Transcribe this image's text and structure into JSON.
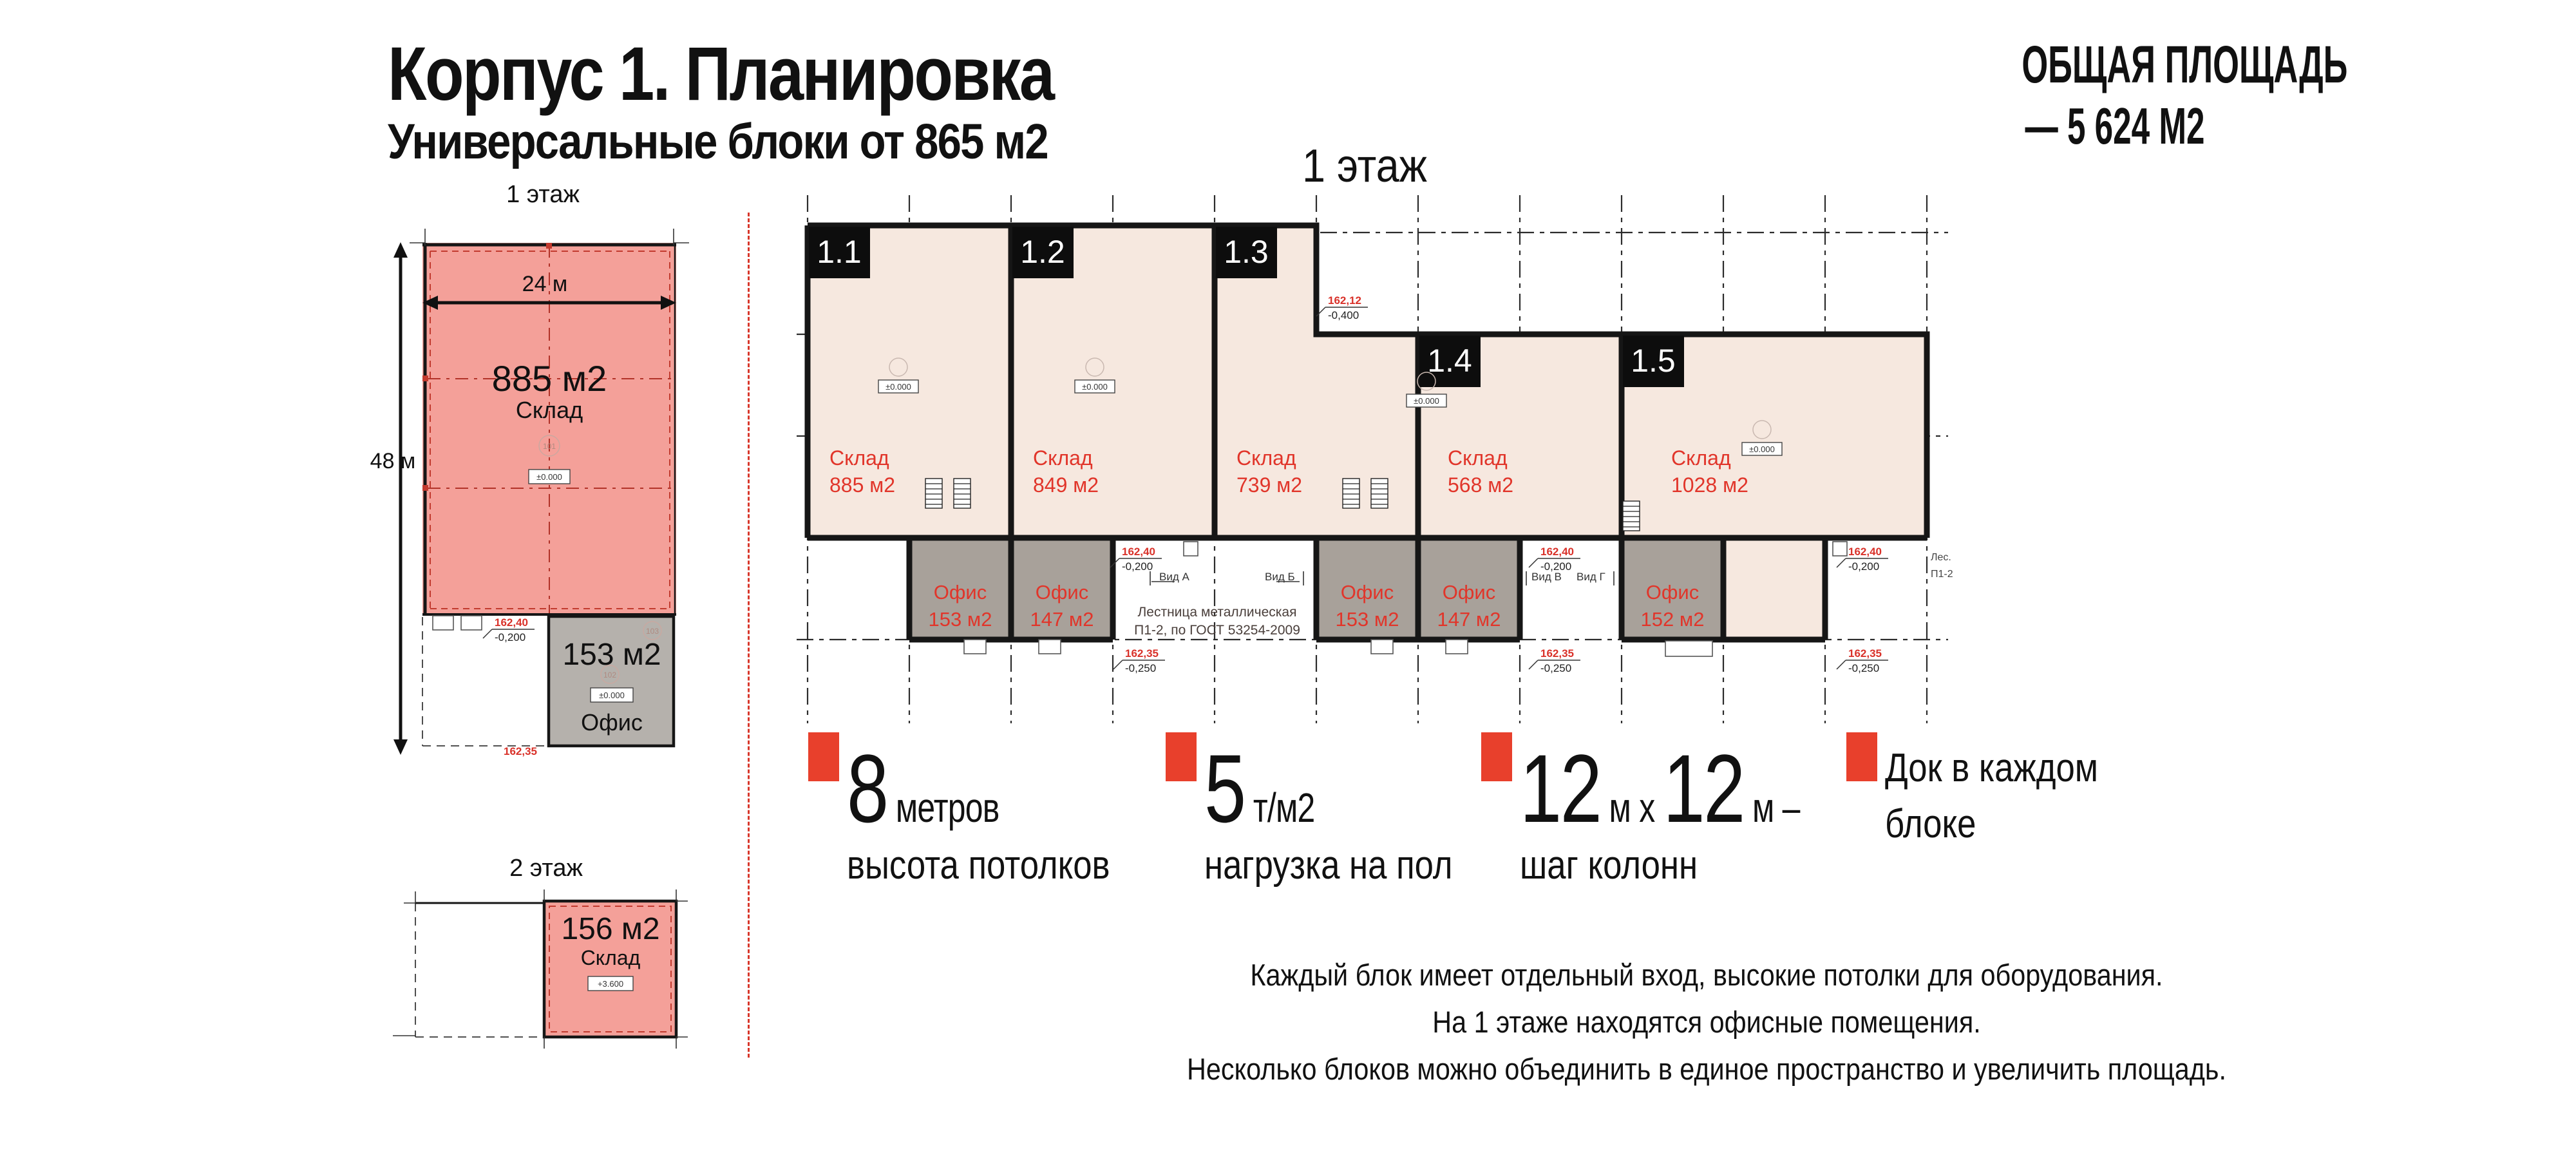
{
  "header": {
    "title": "Корпус 1. Планировка",
    "subtitle": "Универсальные блоки от 865 м2",
    "total_area_title": "ОБЩАЯ ПЛОЩАДЬ",
    "total_area_value": "— 5 624 М2"
  },
  "side_plans": {
    "floor1": {
      "label": "1 этаж",
      "width_dim": "24 м",
      "depth_dim": "48 м",
      "warehouse": {
        "area": "885 м2",
        "label": "Склад",
        "room": "101",
        "elevation": "±0.000"
      },
      "office": {
        "area": "153 м2",
        "label": "Офис",
        "room_a": "102",
        "room_b": "103",
        "elevation": "±0.000"
      },
      "marks": {
        "level_top": "162,40",
        "level_top2": "-0,200",
        "level_bottom": "162,35"
      }
    },
    "floor2": {
      "label": "2 этаж",
      "warehouse": {
        "area": "156 м2",
        "label": "Склад",
        "elevation": "+3.600"
      }
    }
  },
  "main_plan": {
    "heading": "1 этаж",
    "blocks": [
      {
        "tag": "1.1",
        "type": "Склад",
        "area": "885 м2"
      },
      {
        "tag": "1.2",
        "type": "Склад",
        "area": "849 м2"
      },
      {
        "tag": "1.3",
        "type": "Склад",
        "area": "739 м2"
      },
      {
        "tag": "1.4",
        "type": "Склад",
        "area": "568 м2"
      },
      {
        "tag": "1.5",
        "type": "Склад",
        "area": "1028 м2"
      }
    ],
    "offices": [
      {
        "label": "Офис",
        "area": "153 м2"
      },
      {
        "label": "Офис",
        "area": "147 м2"
      },
      {
        "label": "Офис",
        "area": "153 м2"
      },
      {
        "label": "Офис",
        "area": "147 м2"
      },
      {
        "label": "Офис",
        "area": "152 м2"
      }
    ],
    "elevation_box": "±0.000",
    "stair_note": {
      "line1": "Лестница металлическая",
      "line2": "П1-2, по ГОСТ 53254-2009"
    },
    "stair_label": {
      "line1": "Лес.",
      "line2": "П1-2"
    },
    "views": {
      "a": "Вид А",
      "b": "Вид Б",
      "v": "Вид В",
      "g": "Вид Г"
    },
    "marks": {
      "upper": "162,40",
      "upper2": "-0,200",
      "lower": "162,35",
      "lower2": "-0,250",
      "step": "162,12",
      "step2": "-0,400"
    }
  },
  "features": [
    {
      "big": "8",
      "small": " метров",
      "caption": "высота потолков"
    },
    {
      "big": "5",
      "small": " т/м2",
      "caption": "нагрузка на пол"
    },
    {
      "big": "12",
      "small": " м х ",
      "big2": "12",
      "small2": " м –",
      "caption": "шаг колонн"
    },
    {
      "line1": "Док в каждом",
      "line2": "блоке"
    }
  ],
  "notes": [
    "Каждый блок имеет отдельный вход, высокие потолки для оборудования.",
    "На 1 этаже находятся офисные помещения.",
    "Несколько блоков можно объединить в единое пространство и увеличить площадь."
  ],
  "colors": {
    "pink": "#F4A099",
    "peach": "#F6E8DF",
    "office_gray": "#A8A19A",
    "side_office_gray": "#B5B1AC",
    "label_red": "#E1352A",
    "accent_red": "#E8402C",
    "mark_red": "#D9322A",
    "wall": "#161616"
  }
}
